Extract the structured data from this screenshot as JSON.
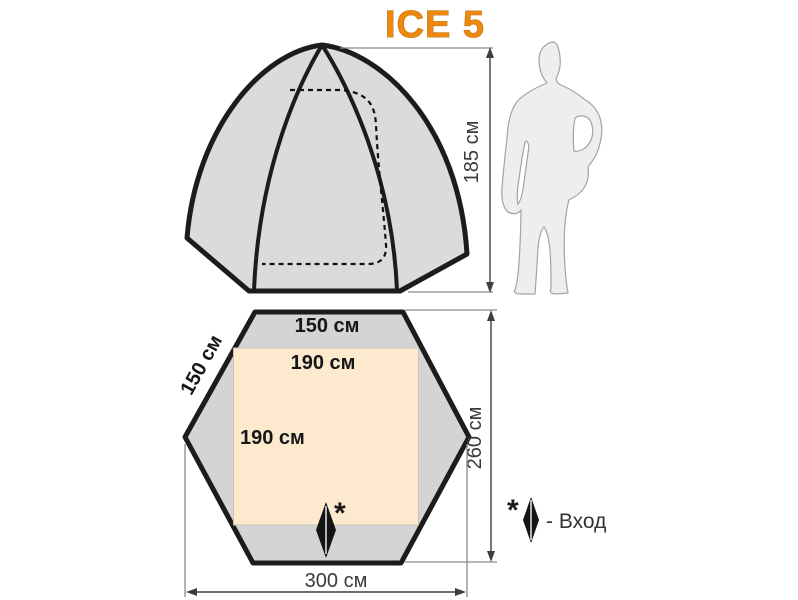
{
  "title": "ICE 5",
  "side_view": {
    "height_dimension": "185 см"
  },
  "floor_plan": {
    "top_edge_width": "150 см",
    "left_edge_width": "150 см",
    "inner_floor_width": "190 см",
    "inner_floor_depth": "190 см",
    "total_depth": "260 см",
    "total_width": "300 см",
    "entrance_mark": "*"
  },
  "legend": {
    "mark": "*",
    "entrance_label": "- Вход"
  },
  "colors": {
    "accent_orange": "#ED870D",
    "tent_fill": "#DBDBDB",
    "plan_fill": "#D4D4D4",
    "floor_fill": "#FCE9CE",
    "outline": "#1C1C1C",
    "dimension_line": "#3F3F3F",
    "silhouette_fill": "#EEEEEE"
  }
}
